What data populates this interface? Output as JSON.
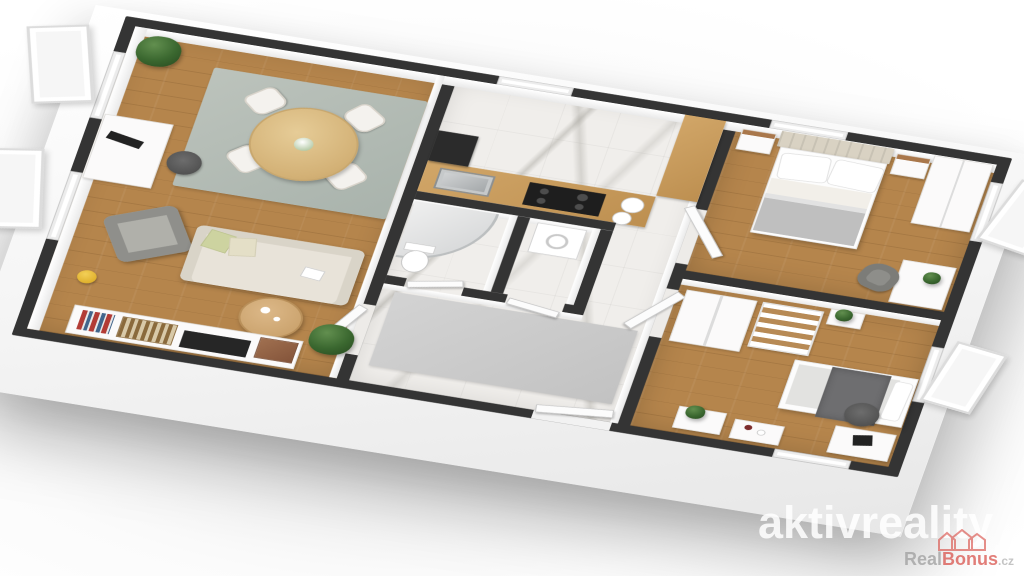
{
  "watermark": {
    "text": "aktivreality"
  },
  "brand": {
    "name_primary": "Real",
    "name_accent": "Bonus",
    "domain_suffix": ".cz",
    "icon": "houses-icon"
  },
  "palette": {
    "wall_dark": "#343434",
    "wood_floor": "#b5854c",
    "marble_floor": "#f0eeeb",
    "area_rug": "#a9b3ac",
    "hall_mat": "#c6c6c6",
    "counter_wood": "#c49a5c",
    "sofa_cream": "#e8e3d9",
    "armchair_gray": "#9c9c98",
    "bed_blanket_gray": "#bfbfbf",
    "single_bed_blanket": "#6e6e70",
    "plant_green": "#3a672f",
    "vase_yellow": "#e9b62a",
    "brand_gray": "#9e9e9e",
    "brand_red": "#d9534c",
    "watermark_white": "#ffffff"
  },
  "scene": {
    "type": "3d-floorplan-render",
    "rooms": [
      {
        "name": "living-dining-room",
        "floor": "wood",
        "furniture": [
          "round-dining-table",
          "dining-chairs-x4",
          "flower-vase",
          "area-rug",
          "sofa",
          "throw-pillows",
          "armchair",
          "coffee-table",
          "tv-sideboard",
          "storage-boxes",
          "basket",
          "desk",
          "monitor",
          "office-chair",
          "potted-plant-x2",
          "yellow-vase"
        ]
      },
      {
        "name": "kitchen",
        "floor": "marble",
        "furniture": [
          "l-shaped-counter",
          "steel-sink",
          "black-cooktop",
          "tall-dark-cabinet",
          "plates-x2",
          "window"
        ]
      },
      {
        "name": "bathroom",
        "floor": "marble",
        "furniture": [
          "corner-shower",
          "toilet"
        ]
      },
      {
        "name": "wc-utility",
        "floor": "marble",
        "furniture": [
          "washing-machine"
        ]
      },
      {
        "name": "hallway",
        "floor": "marble",
        "furniture": [
          "gray-mat",
          "entrance-door"
        ]
      },
      {
        "name": "master-bedroom",
        "floor": "wood",
        "furniture": [
          "double-bed",
          "upholstered-headboard",
          "pillows-x2",
          "gray-blanket",
          "nightstand-x2",
          "wardrobe",
          "desk",
          "armchair",
          "plant",
          "windows"
        ]
      },
      {
        "name": "second-bedroom",
        "floor": "wood",
        "furniture": [
          "single-bed",
          "dark-blanket",
          "wardrobe",
          "open-shelf-unit",
          "console-tables",
          "desk",
          "laptop",
          "office-chair",
          "plants",
          "windows"
        ]
      }
    ]
  }
}
